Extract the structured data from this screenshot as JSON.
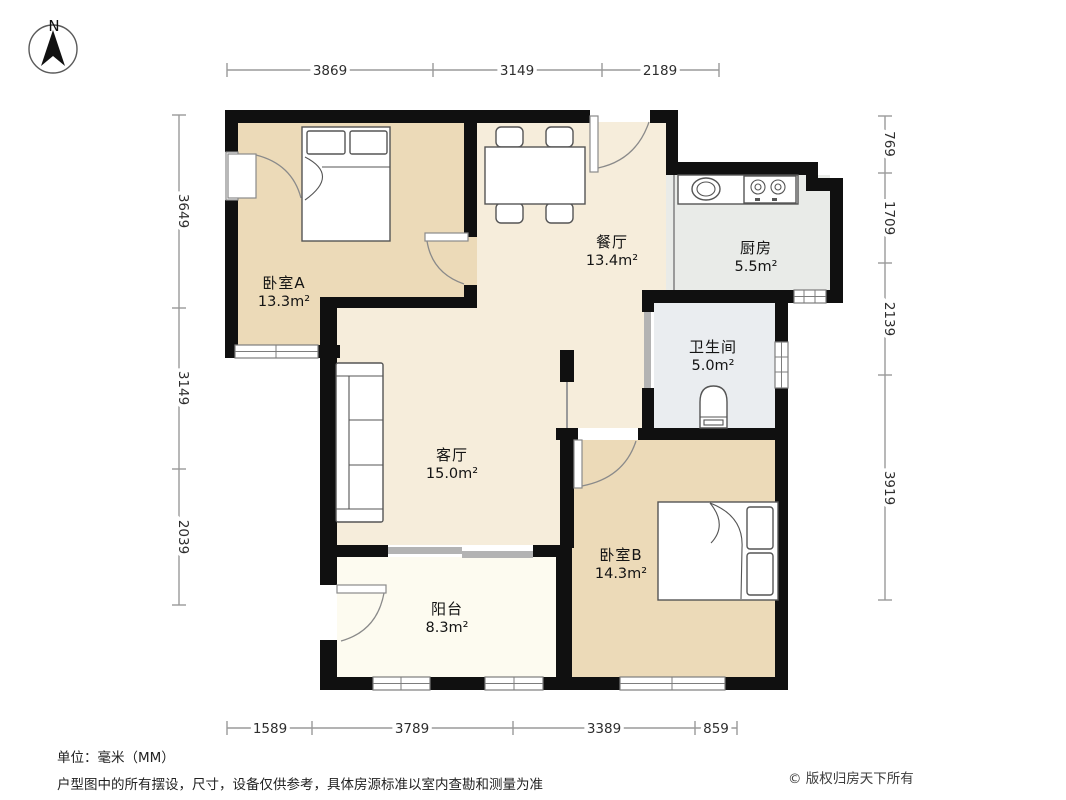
{
  "compass": {
    "label": "N"
  },
  "rooms": [
    {
      "id": "bedroom-a",
      "name": "卧室A",
      "area": "13.3m²"
    },
    {
      "id": "dining",
      "name": "餐厅",
      "area": "13.4m²"
    },
    {
      "id": "kitchen",
      "name": "厨房",
      "area": "5.5m²"
    },
    {
      "id": "bathroom",
      "name": "卫生间",
      "area": "5.0m²"
    },
    {
      "id": "living",
      "name": "客厅",
      "area": "15.0m²"
    },
    {
      "id": "bedroom-b",
      "name": "卧室B",
      "area": "14.3m²"
    },
    {
      "id": "balcony",
      "name": "阳台",
      "area": "8.3m²"
    }
  ],
  "dimensions": {
    "top": [
      "3869",
      "3149",
      "2189"
    ],
    "bottom": [
      "1589",
      "3789",
      "3389",
      "859"
    ],
    "left": [
      "3649",
      "3149",
      "2039"
    ],
    "right": [
      "769",
      "1709",
      "2139",
      "3919"
    ]
  },
  "footer": {
    "unit_note": "单位：毫米（MM）",
    "disclaimer": "户型图中的所有摆设，尺寸，设备仅供参考，具体房源标准以室内查勘和测量为准",
    "copyright": "© 版权归房天下所有"
  },
  "watermark": {
    "text": "fang.com"
  },
  "colors": {
    "c_wall": "#101010",
    "c_bedroom": "#ecdab8",
    "c_living": "#f6eddb",
    "c_kitchen": "#e9ebe8",
    "c_bath": "#eaedf0",
    "c_balcony": "#fdfbf0"
  }
}
